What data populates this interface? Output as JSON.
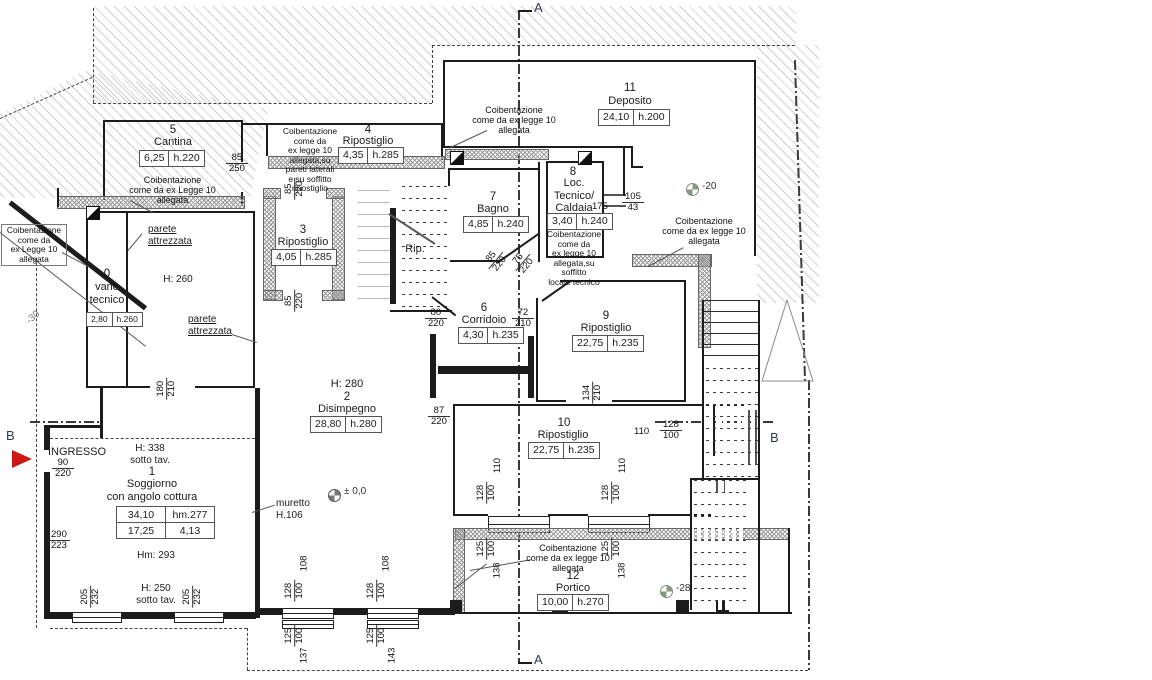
{
  "rooms": [
    {
      "number": "0",
      "name": "vano\ntecnico",
      "area": "2,80",
      "height": "h.260"
    },
    {
      "number": "1",
      "name": "Soggiorno\ncon angolo cottura",
      "area": "34,10",
      "height": "hm.277",
      "area2": "17,25",
      "height2": "4,13"
    },
    {
      "number": "2",
      "name": "Disimpegno",
      "area": "28,80",
      "height": "h.280"
    },
    {
      "number": "3",
      "name": "Ripostiglio",
      "area": "4,05",
      "height": "h.285"
    },
    {
      "number": "4",
      "name": "Ripostiglio",
      "area": "4,35",
      "height": "h.285"
    },
    {
      "number": "5",
      "name": "Cantina",
      "area": "6,25",
      "height": "h.220"
    },
    {
      "number": "6",
      "name": "Corridoio",
      "area": "4,30",
      "height": "h.235"
    },
    {
      "number": "7",
      "name": "Bagno",
      "area": "4,85",
      "height": "h.240"
    },
    {
      "number": "8",
      "name": "Loc.\nTecnico/\nCaldaia",
      "area": "3,40",
      "height": "h.240"
    },
    {
      "number": "9",
      "name": "Ripostiglio",
      "area": "22,75",
      "height": "h.235"
    },
    {
      "number": "10",
      "name": "Ripostiglio",
      "area": "22,75",
      "height": "h.235"
    },
    {
      "number": "11",
      "name": "Deposito",
      "area": "24,10",
      "height": "h.200"
    },
    {
      "number": "12",
      "name": "Portico",
      "area": "10,00",
      "height": "h.270"
    }
  ],
  "notes": {
    "cantina": "Coibentazione\ncome da ex Legge 10\nallegata",
    "rip4": "Coibentazione\ncome da\nex legge 10\nallegata,su\npareti laterali\ne su soffitto\nripostiglio",
    "left": "Coibentazione\ncome da\nex Legge 10\nallegata",
    "deposito": "Coibentazione\ncome da ex legge 10\nallegata",
    "caldaia": "Coibentazione\ncome da\nex legge 10\nallegata,su soffitto\nlocale tecnico",
    "right": "Coibentazione\ncome da ex legge 10\nallegata",
    "portico": "Coibentazione\ncome da ex legge 10\nallegata"
  },
  "labels": {
    "ingresso": "INGRESSO",
    "rip": "Rip.",
    "muretto": "muretto\nH.106",
    "parete_attrezzata": "parete\nattrezzata",
    "h260": "H: 260",
    "h280": "H: 280",
    "h338": "H: 338\nsotto tav.",
    "hm293": "Hm: 293",
    "h250": "H: 250\nsotto tav.",
    "caldaia_width": "175"
  },
  "levels": {
    "l30": "-30",
    "l20": "-20",
    "l0": "± 0,0",
    "l28": "-28"
  },
  "sections": {
    "a": "A",
    "b": "B"
  },
  "dims": {
    "cantina_door": {
      "t": "85",
      "b": "250"
    },
    "rip3_top": {
      "t": "85",
      "b": "220"
    },
    "rip3_bot": {
      "t": "85",
      "b": "220"
    },
    "caldaia_win": {
      "t": "105",
      "b": "43"
    },
    "bagno_door": {
      "t": "85",
      "b": "220"
    },
    "loctec_door": {
      "t": "75",
      "b": "220"
    },
    "corr_door1": {
      "t": "80",
      "b": "220"
    },
    "corr_door2": {
      "t": "72",
      "b": "210"
    },
    "dis_door": {
      "t": "87",
      "b": "220"
    },
    "rip9_door": {
      "t": "134",
      "b": "210"
    },
    "rip10_right": {
      "t": "128",
      "b": "100"
    },
    "rip10_right_w": "110",
    "rip10_win1": {
      "t": "128",
      "b": "100"
    },
    "rip10_win1_w": "110",
    "rip10_win2": {
      "t": "128",
      "b": "100"
    },
    "rip10_win2_w": "110",
    "portico_win1": {
      "t": "125",
      "b": "100"
    },
    "portico_win1_x": "138",
    "portico_win2": {
      "t": "125",
      "b": "100"
    },
    "portico_win2_x": "138",
    "dis_win1_w": "108",
    "dis_win1": {
      "t": "128",
      "b": "100"
    },
    "dis_win1_s": {
      "t": "125",
      "b": "100"
    },
    "dis_win1_b": "137",
    "dis_win2_w": "108",
    "dis_win2": {
      "t": "128",
      "b": "100"
    },
    "dis_win2_s": {
      "t": "125",
      "b": "100"
    },
    "dis_win2_b": "143",
    "ingresso_door": {
      "t": "90",
      "b": "220"
    },
    "sog_left": {
      "t": "290",
      "b": "223"
    },
    "sog_win1": {
      "t": "205",
      "b": "232"
    },
    "sog_win2": {
      "t": "205",
      "b": "232"
    },
    "vano_door": {
      "t": "180",
      "b": "210"
    }
  }
}
